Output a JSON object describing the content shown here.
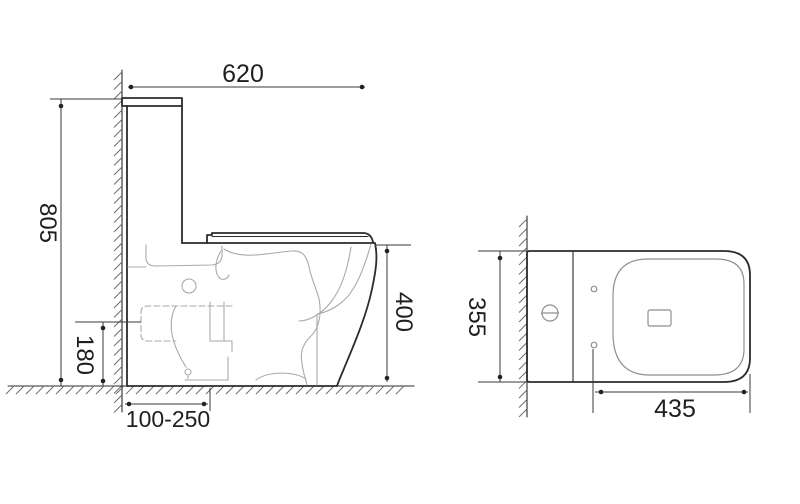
{
  "drawing": {
    "side_view": {
      "overall_depth_label": "620",
      "overall_height_label": "805",
      "outlet_height_label": "180",
      "rough_in_range_label": "100-250",
      "seat_height_label": "400"
    },
    "top_view": {
      "overall_width_label": "355",
      "seat_length_label": "435"
    },
    "colors": {
      "background": "#ffffff",
      "main_line": "#2b2b2b",
      "dimension_line": "#3a3a3a",
      "sketch_line": "#a9a9a9",
      "text": "#1f1f1f"
    }
  }
}
